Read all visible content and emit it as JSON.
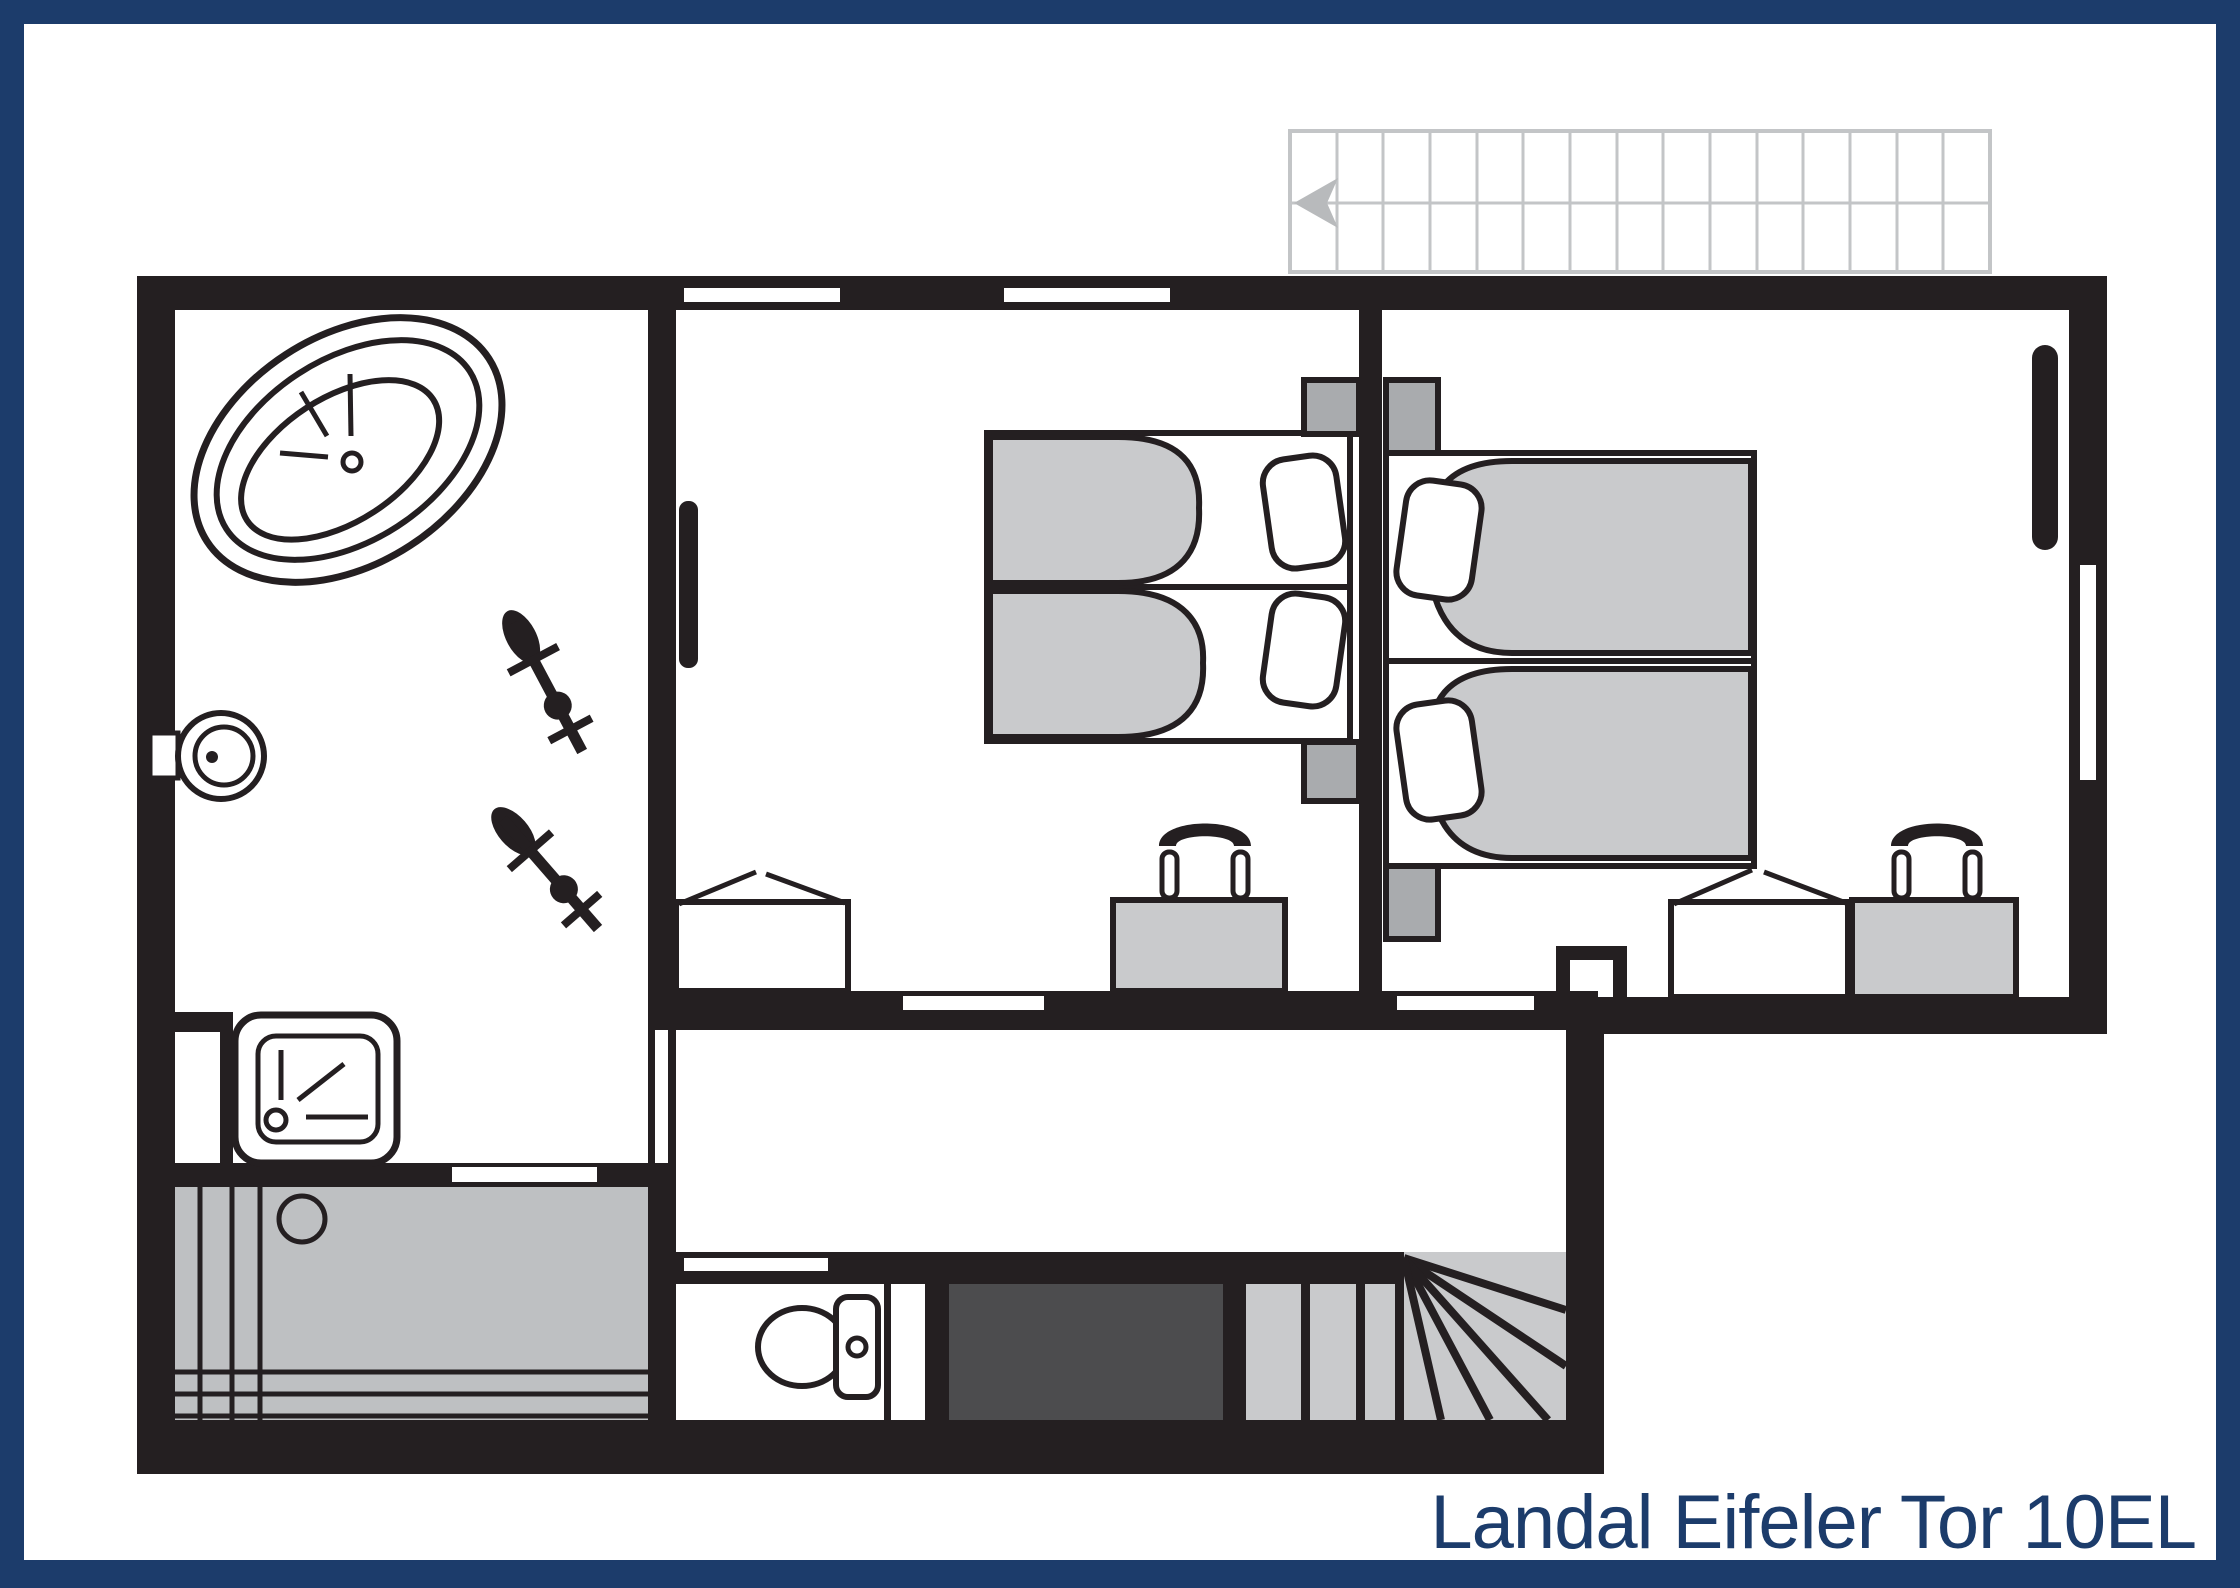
{
  "title": "Landal Eifeler Tor 10EL",
  "colors": {
    "frame_navy": "#1c3c6b",
    "wall_black": "#241f21",
    "furniture_light_gray": "#c9cacc",
    "nightstand_gray": "#a9abae",
    "terrace_gray": "#bec0c2",
    "doormat_dark_gray": "#4c4c4e",
    "ghost_stair_gray": "#c3c5c7",
    "ghost_arrow_gray": "#b8babc"
  },
  "floor_plan": {
    "upper_staircase": {
      "treads": 15,
      "direction_arrow": "left"
    },
    "rooms": [
      {
        "name": "bathroom",
        "items": [
          "bathtub",
          "washbasin",
          "radiator",
          "radiator",
          "shower"
        ]
      },
      {
        "name": "bedroom-left",
        "items": [
          "single-bed",
          "single-bed",
          "nightstand",
          "nightstand",
          "wardrobe",
          "desk",
          "chair",
          "wall-radiator",
          "window"
        ]
      },
      {
        "name": "bedroom-right",
        "items": [
          "single-bed",
          "single-bed",
          "nightstand",
          "nightstand",
          "wardrobe",
          "desk",
          "chair",
          "wall-radiator",
          "window"
        ]
      },
      {
        "name": "landing-hallway",
        "items": []
      },
      {
        "name": "wc",
        "items": [
          "toilet"
        ]
      },
      {
        "name": "stairwell",
        "items": [
          "winder-staircase",
          "doormat"
        ]
      },
      {
        "name": "terrace",
        "items": [
          "table"
        ]
      }
    ]
  }
}
